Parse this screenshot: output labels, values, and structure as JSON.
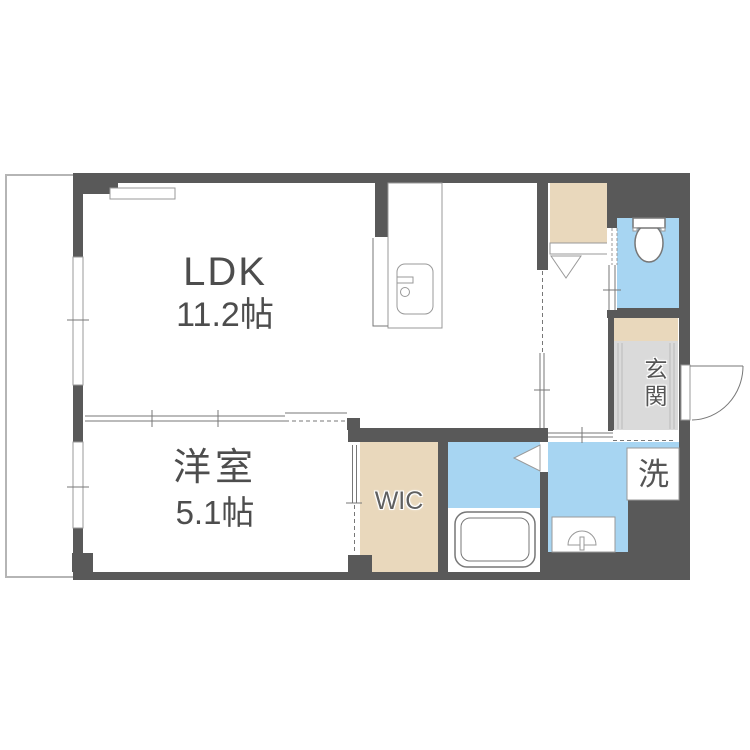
{
  "rooms": {
    "ldk": {
      "name": "LDK",
      "area": "11.2帖"
    },
    "bedroom": {
      "name": "洋室",
      "area": "5.1帖"
    },
    "wic": {
      "name": "WIC"
    },
    "genkan": {
      "name": "玄関"
    },
    "laundry": {
      "name": "洗"
    }
  },
  "fixtures": {
    "toilet": "toilet-icon",
    "bathtub": "bathtub-icon",
    "washbasin": "washbasin-faucet-icon",
    "kitchen_sink": "kitchen-sink-icon",
    "air_conditioner": "ac-unit-outline-icon",
    "entrance_door": "door-swing-arc-icon",
    "closet_door": "door-swing-triangle-icon",
    "sliding_doors": "double-line-sliding-door-icon",
    "windows": "wall-window-icon",
    "balcony": "balcony-outline-icon"
  },
  "colors": {
    "wall": "#595959",
    "closet_beige": "#e9d8bc",
    "wet_area_blue": "#a7d5f2",
    "genkan_gray": "#dadada",
    "balcony_line": "#b5b5b5",
    "fixture_line": "#777777",
    "label_text": "#4d4d4d"
  }
}
